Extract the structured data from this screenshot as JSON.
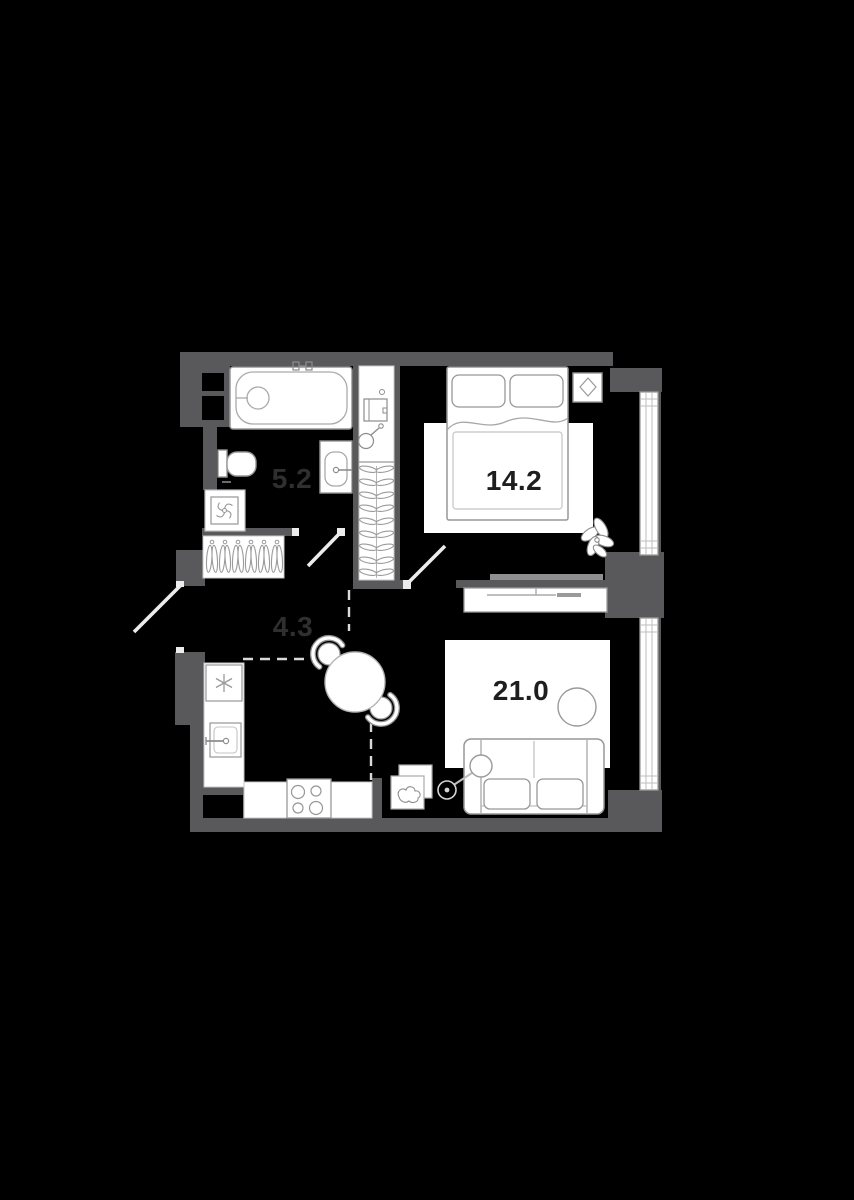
{
  "plan": {
    "description": "apartment floor plan",
    "rooms": [
      {
        "id": "bathroom",
        "area_label": "5.2",
        "label_color": "#2f2f2f"
      },
      {
        "id": "bedroom",
        "area_label": "14.2",
        "label_color": "#1e1e1e"
      },
      {
        "id": "hallway",
        "area_label": "4.3",
        "label_color": "#2f2f2f"
      },
      {
        "id": "living-kitchen",
        "area_label": "21.0",
        "label_color": "#1e1e1e"
      }
    ]
  },
  "colors": {
    "background": "#000000",
    "wall": "#59595b",
    "floor": "#000000",
    "furniture_fill": "#ffffff",
    "furniture_stroke": "#979797",
    "light_stroke": "#c4c4c4",
    "door_leaf": "#ececec",
    "dashed_zone_line": "#d9d9d9",
    "tv_bar": "#8f8f8f"
  },
  "fixtures": [
    "bathtub-icon",
    "toilet-icon",
    "bath-sink-icon",
    "vent-fan-icon",
    "coat-rack-hangers-icon",
    "wardrobe-hangers-icon",
    "water-heater-icon",
    "shower-head-icon",
    "double-bed-icon",
    "nightstand-icon",
    "plant-icon",
    "tv-icon",
    "tv-console-icon",
    "rug-icon",
    "sofa-icon",
    "coffee-table-icon",
    "floor-lamp-icon",
    "picture-frames-icon",
    "dining-table-icon",
    "chair-icon",
    "fridge-snowflake-icon",
    "kitchen-sink-icon",
    "stove-burners-icon",
    "window-icon",
    "door-swing-icon"
  ]
}
